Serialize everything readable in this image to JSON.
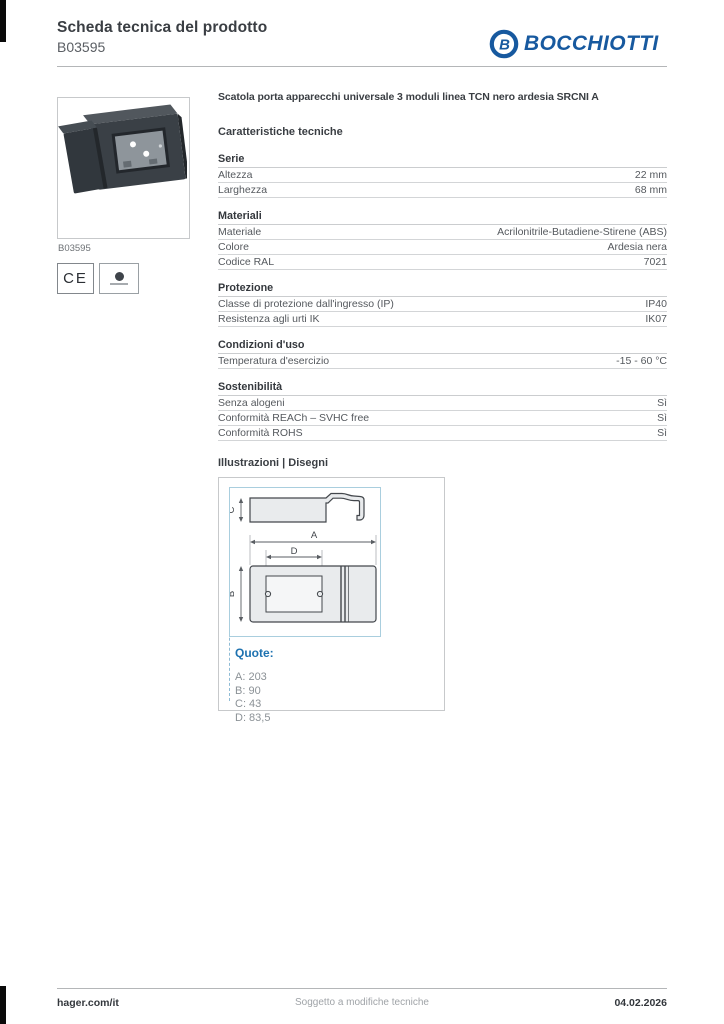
{
  "page": {
    "title": "Scheda tecnica del prodotto",
    "product_code": "B03595",
    "brand": "BOCCHIOTTI",
    "brand_color": "#17599f"
  },
  "product": {
    "description": "Scatola porta apparecchi universale 3 moduli linea TCN nero ardesia SRCNI A",
    "image_caption": "B03595",
    "ce_mark": "CE"
  },
  "tech": {
    "heading": "Caratteristiche tecniche",
    "sections": [
      {
        "title": "Serie",
        "rows": [
          {
            "label": "Altezza",
            "value": "22 mm"
          },
          {
            "label": "Larghezza",
            "value": "68 mm"
          }
        ]
      },
      {
        "title": "Materiali",
        "rows": [
          {
            "label": "Materiale",
            "value": "Acrilonitrile-Butadiene-Stirene (ABS)"
          },
          {
            "label": "Colore",
            "value": "Ardesia nera"
          },
          {
            "label": "Codice RAL",
            "value": "7021"
          }
        ]
      },
      {
        "title": "Protezione",
        "rows": [
          {
            "label": "Classe di protezione dall'ingresso (IP)",
            "value": "IP40"
          },
          {
            "label": "Resistenza agli urti IK",
            "value": "IK07"
          }
        ]
      },
      {
        "title": "Condizioni d'uso",
        "rows": [
          {
            "label": "Temperatura d'esercizio",
            "value": "-15 - 60 °C"
          }
        ]
      },
      {
        "title": "Sostenibilità",
        "rows": [
          {
            "label": "Senza alogeni",
            "value": "Sì"
          },
          {
            "label": "Conformità REACh – SVHC free",
            "value": "Sì"
          },
          {
            "label": "Conformità ROHS",
            "value": "Sì"
          }
        ]
      }
    ]
  },
  "illustrations": {
    "heading": "Illustrazioni | Disegni",
    "quote_label": "Quote:",
    "dimensions": [
      "A: 203",
      "B: 90",
      "C: 43",
      "D: 83,5"
    ],
    "drawing_labels": {
      "a": "A",
      "b": "B",
      "c": "C",
      "d": "D"
    },
    "accent_color": "#1e72b0"
  },
  "footer": {
    "link": "hager.com/it",
    "note": "Soggetto a modifiche tecniche",
    "date": "04.02.2026"
  }
}
